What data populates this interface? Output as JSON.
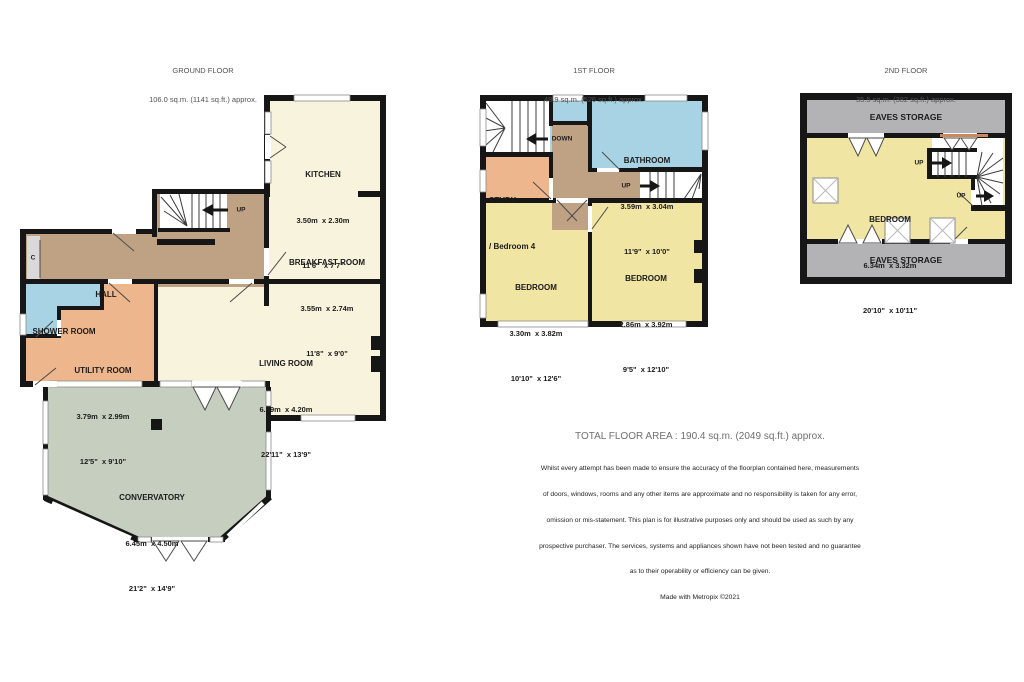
{
  "palette": {
    "wall": "#161616",
    "cream": "#f8f3dd",
    "yellow": "#f1e5a3",
    "brown": "#bfa284",
    "orange": "#eeb68c",
    "blue": "#a8d3e4",
    "sage": "#c6cec0",
    "eaves": "#b3b3b6",
    "closet": "#d9d9d9",
    "rail": "#c9895c"
  },
  "floors": [
    {
      "title": "GROUND FLOOR",
      "subtitle": "106.0 sq.m. (1141 sq.ft.) approx.",
      "rooms": [
        {
          "name": "KITCHEN",
          "metric": "3.50m  x 2.30m",
          "imperial": "11'6\"  x 7'7\""
        },
        {
          "name": "BREAKFAST ROOM",
          "metric": "3.55m  x 2.74m",
          "imperial": "11'8\"  x 9'0\""
        },
        {
          "name": "HALL"
        },
        {
          "name": "SHOWER ROOM"
        },
        {
          "name": "UTILITY ROOM",
          "metric": "3.79m  x 2.99m",
          "imperial": "12'5\"  x 9'10\""
        },
        {
          "name": "LIVING ROOM",
          "metric": "6.99m  x 4.20m",
          "imperial": "22'11\"  x 13'9\""
        },
        {
          "name": "CONVERVATORY",
          "metric": "6.45m  x 4.50m",
          "imperial": "21'2\"  x 14'9\""
        }
      ],
      "annotations": {
        "up": "UP",
        "closet": "C"
      }
    },
    {
      "title": "1ST FLOOR",
      "subtitle": "48.9 sq.m. (526 sq.ft.) approx.",
      "rooms": [
        {
          "name": "BATHROOM",
          "metric": "3.59m  x 3.04m",
          "imperial": "11'9\"  x 10'0\""
        },
        {
          "name": "STUDY",
          "name2": "/ Bedroom 4"
        },
        {
          "name": "BEDROOM",
          "metric": "3.30m  x 3.82m",
          "imperial": "10'10\"  x 12'6\""
        },
        {
          "name": "BEDROOM",
          "metric": "2.86m  x 3.92m",
          "imperial": "9'5\"  x 12'10\""
        }
      ],
      "annotations": {
        "down": "DOWN",
        "up": "UP"
      }
    },
    {
      "title": "2ND FLOOR",
      "subtitle": "35.5 sq.m. (382 sq.ft.) approx.",
      "rooms": [
        {
          "name": "EAVES STORAGE"
        },
        {
          "name": "BEDROOM",
          "metric": "6.34m  x 3.32m",
          "imperial": "20'10\"  x 10'11\""
        },
        {
          "name": "EAVES STORAGE"
        }
      ],
      "annotations": {
        "up_upper": "UP",
        "up_lower": "UP"
      }
    }
  ],
  "footer": {
    "total": "TOTAL FLOOR AREA : 190.4 sq.m. (2049 sq.ft.) approx.",
    "disclaimer_lines": [
      "Whilst every attempt has been made to ensure the accuracy of the floorplan contained here, measurements",
      "of doors, windows, rooms and any other items are approximate and no responsibility is taken for any error,",
      "omission or mis-statement. This plan is for illustrative purposes only and should be used as such by any",
      "prospective purchaser. The services, systems and appliances shown have not been tested and no guarantee",
      "as to their operability or efficiency can be given.",
      "Made with Metropix ©2021"
    ]
  }
}
